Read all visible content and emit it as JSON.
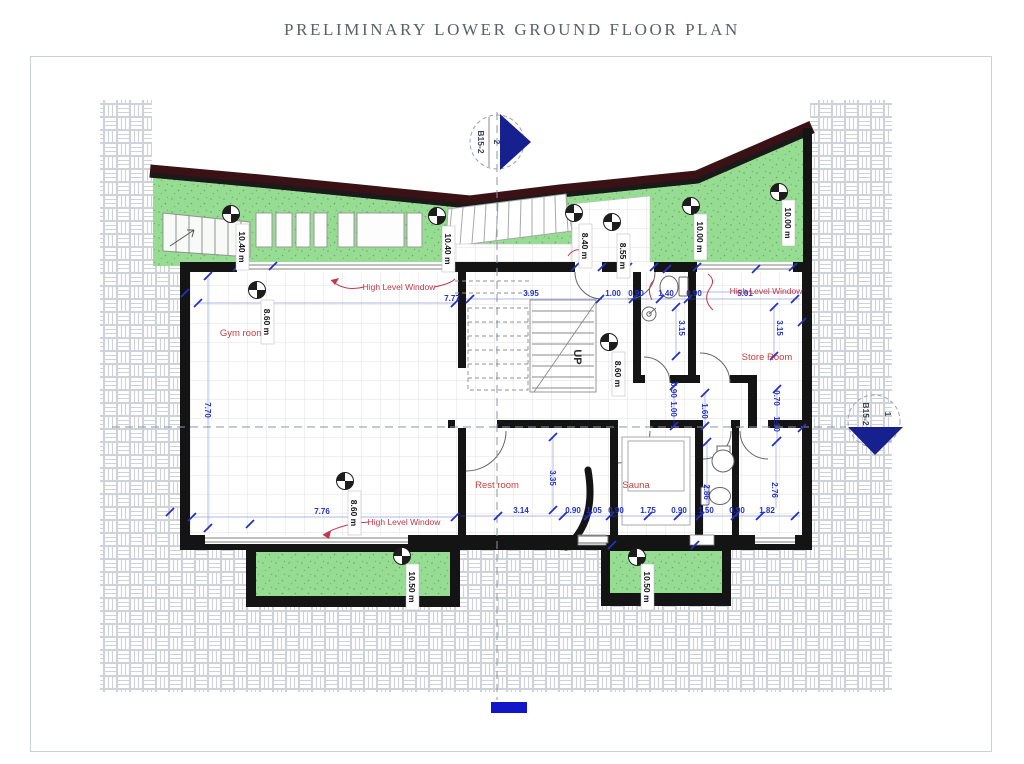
{
  "title": "PRELIMINARY LOWER GROUND FLOOR PLAN",
  "plan": {
    "rooms": [
      "Gym room",
      "Rest room",
      "Sauna",
      "Store Room"
    ],
    "annotations": {
      "hlw_top": "High Level Window",
      "hlw_right": "High Level Window",
      "hlw_bottom": "High Level Window",
      "up": "UP"
    },
    "spot_levels": [
      "10.40 m",
      "10.40 m",
      "8.40 m",
      "8.55 m",
      "10.00 m",
      "10.00 m",
      "8.60 m",
      "8.60 m",
      "8.60 m",
      "10.50 m",
      "10.50 m"
    ],
    "dims_h": [
      "7.77",
      "3.95",
      "1.00",
      "0.90",
      "1.40",
      "0.90",
      "5.01",
      "7.76",
      "3.14",
      "0.90",
      "1.05",
      "0.90",
      "1.75",
      "0.90",
      "1.50",
      "0.90",
      "1.82"
    ],
    "dims_v": [
      "7.70",
      "3.15",
      "3.15",
      "3.35",
      "0.90",
      "1.00",
      "1.60",
      "0.70",
      "1.10",
      "2.86",
      "2.76"
    ],
    "sections": {
      "top": {
        "number": "2",
        "sheet": "B15-2"
      },
      "right": {
        "number": "1",
        "sheet": "B15-2"
      }
    },
    "colors": {
      "grass": "#97dc93",
      "wall": "#141414",
      "dim_blue": "#2231c8",
      "label_red": "#c4403f",
      "band_maroon": "#3a1115",
      "marker_blue": "#16208f",
      "scale_bar_blue": "#1216c9"
    }
  }
}
